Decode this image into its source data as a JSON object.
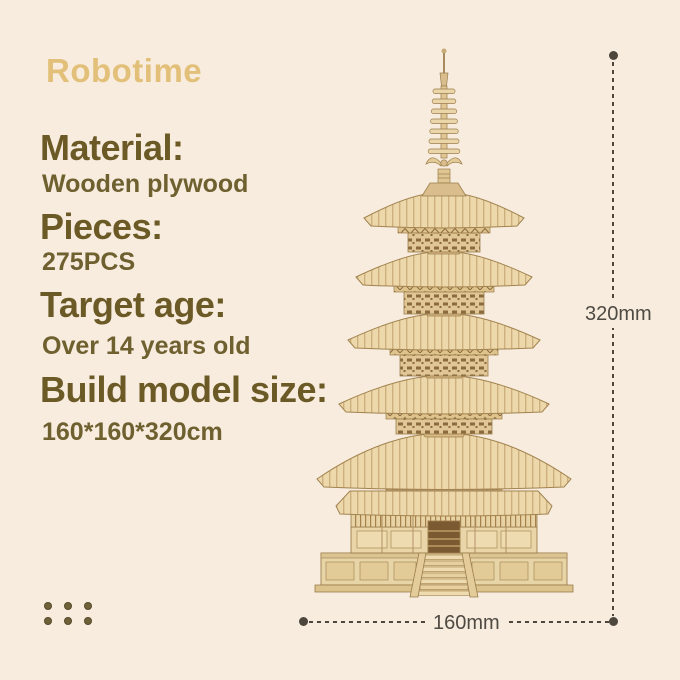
{
  "page": {
    "background_color": "#f7ecde"
  },
  "brand": {
    "logo_text": "Robotime",
    "logo_color": "#e3c07a"
  },
  "specs": {
    "label_color": "#6b5a26",
    "value_color": "#6f6030",
    "items": [
      {
        "label": "Material:",
        "value": "Wooden plywood"
      },
      {
        "label": "Pieces:",
        "value": "275PCS"
      },
      {
        "label": "Target age:",
        "value": "Over 14 years old"
      },
      {
        "label": "Build model size:",
        "value": "160*160*320cm"
      }
    ]
  },
  "dimensions": {
    "line_color": "#4c463c",
    "label_color": "#4f4a42",
    "height": {
      "label": "320mm"
    },
    "width": {
      "label": "160mm"
    }
  },
  "product_image": {
    "alt": "Five-storied pagoda 3D wooden puzzle model",
    "wood_light": "#ecd8ab",
    "wood_mid": "#e0c795",
    "wood_dark": "#8a6a3e"
  }
}
